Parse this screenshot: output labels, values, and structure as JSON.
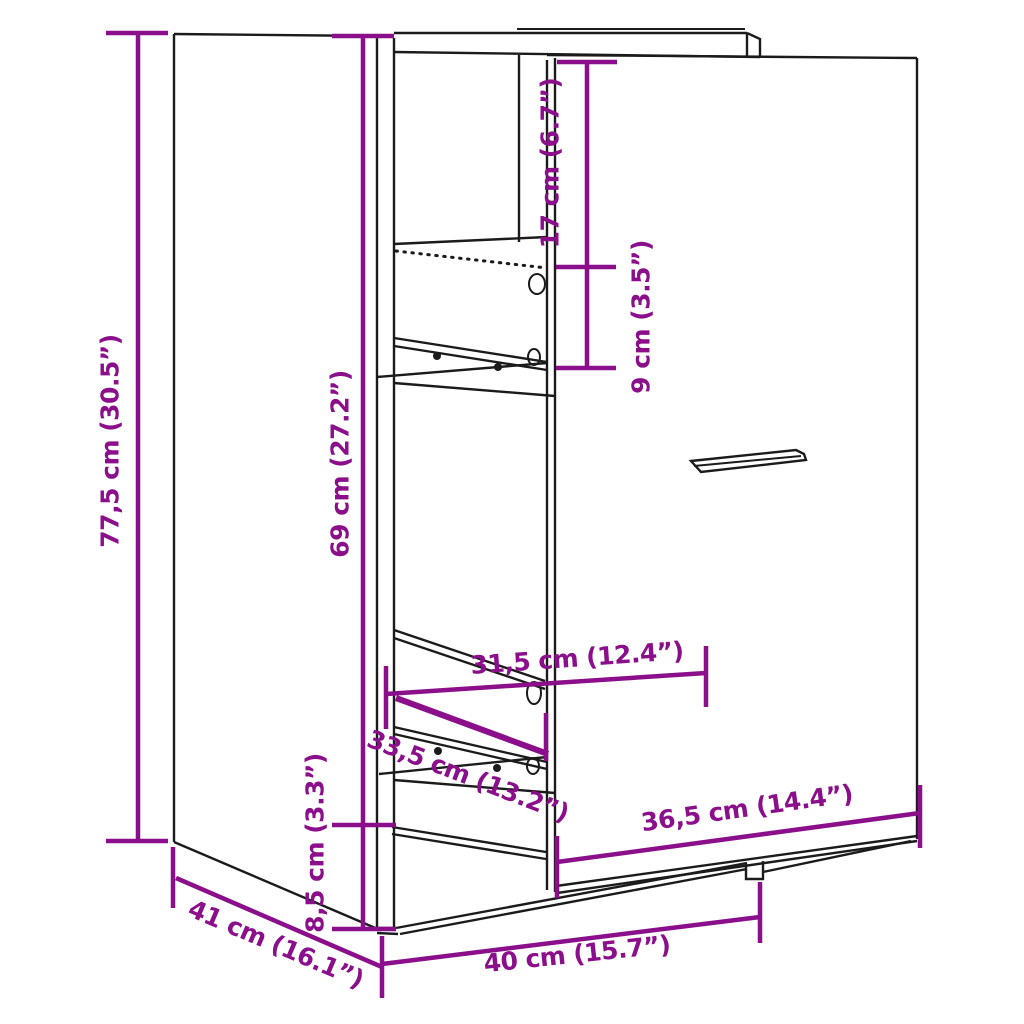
{
  "page": {
    "background": "#ffffff"
  },
  "colors": {
    "dimension_accent": "#8b0f8b",
    "line_art": "#1b1b1b"
  },
  "diagram": {
    "title": "Pull-out cabinet dimension drawing",
    "unit_primary": "cm",
    "unit_secondary": "inch",
    "dimensions": [
      {
        "id": "overall-height",
        "label": "77,5 cm (30.5”)",
        "cm": 77.5,
        "inch": 30.5,
        "orientation": "vertical"
      },
      {
        "id": "pullout-height",
        "label": "69 cm (27.2”)",
        "cm": 69,
        "inch": 27.2,
        "orientation": "vertical"
      },
      {
        "id": "top-section-height",
        "label": "17 cm (6.7”)",
        "cm": 17,
        "inch": 6.7,
        "orientation": "vertical"
      },
      {
        "id": "shelf-spacing",
        "label": "9 cm (3.5”)",
        "cm": 9,
        "inch": 3.5,
        "orientation": "vertical"
      },
      {
        "id": "inner-depth",
        "label": "31,5 cm (12.4”)",
        "cm": 31.5,
        "inch": 12.4,
        "orientation": "horizontal"
      },
      {
        "id": "drawer-depth",
        "label": "33,5 cm (13.2”)",
        "cm": 33.5,
        "inch": 13.2,
        "orientation": "diagonal"
      },
      {
        "id": "front-panel-width",
        "label": "36,5 cm (14.4”)",
        "cm": 36.5,
        "inch": 14.4,
        "orientation": "horizontal"
      },
      {
        "id": "base-height",
        "label": "8,5 cm (3.3”)",
        "cm": 8.5,
        "inch": 3.3,
        "orientation": "vertical"
      },
      {
        "id": "depth",
        "label": "41 cm (16.1”)",
        "cm": 41,
        "inch": 16.1,
        "orientation": "diagonal"
      },
      {
        "id": "width",
        "label": "40 cm (15.7”)",
        "cm": 40,
        "inch": 15.7,
        "orientation": "horizontal"
      }
    ]
  }
}
